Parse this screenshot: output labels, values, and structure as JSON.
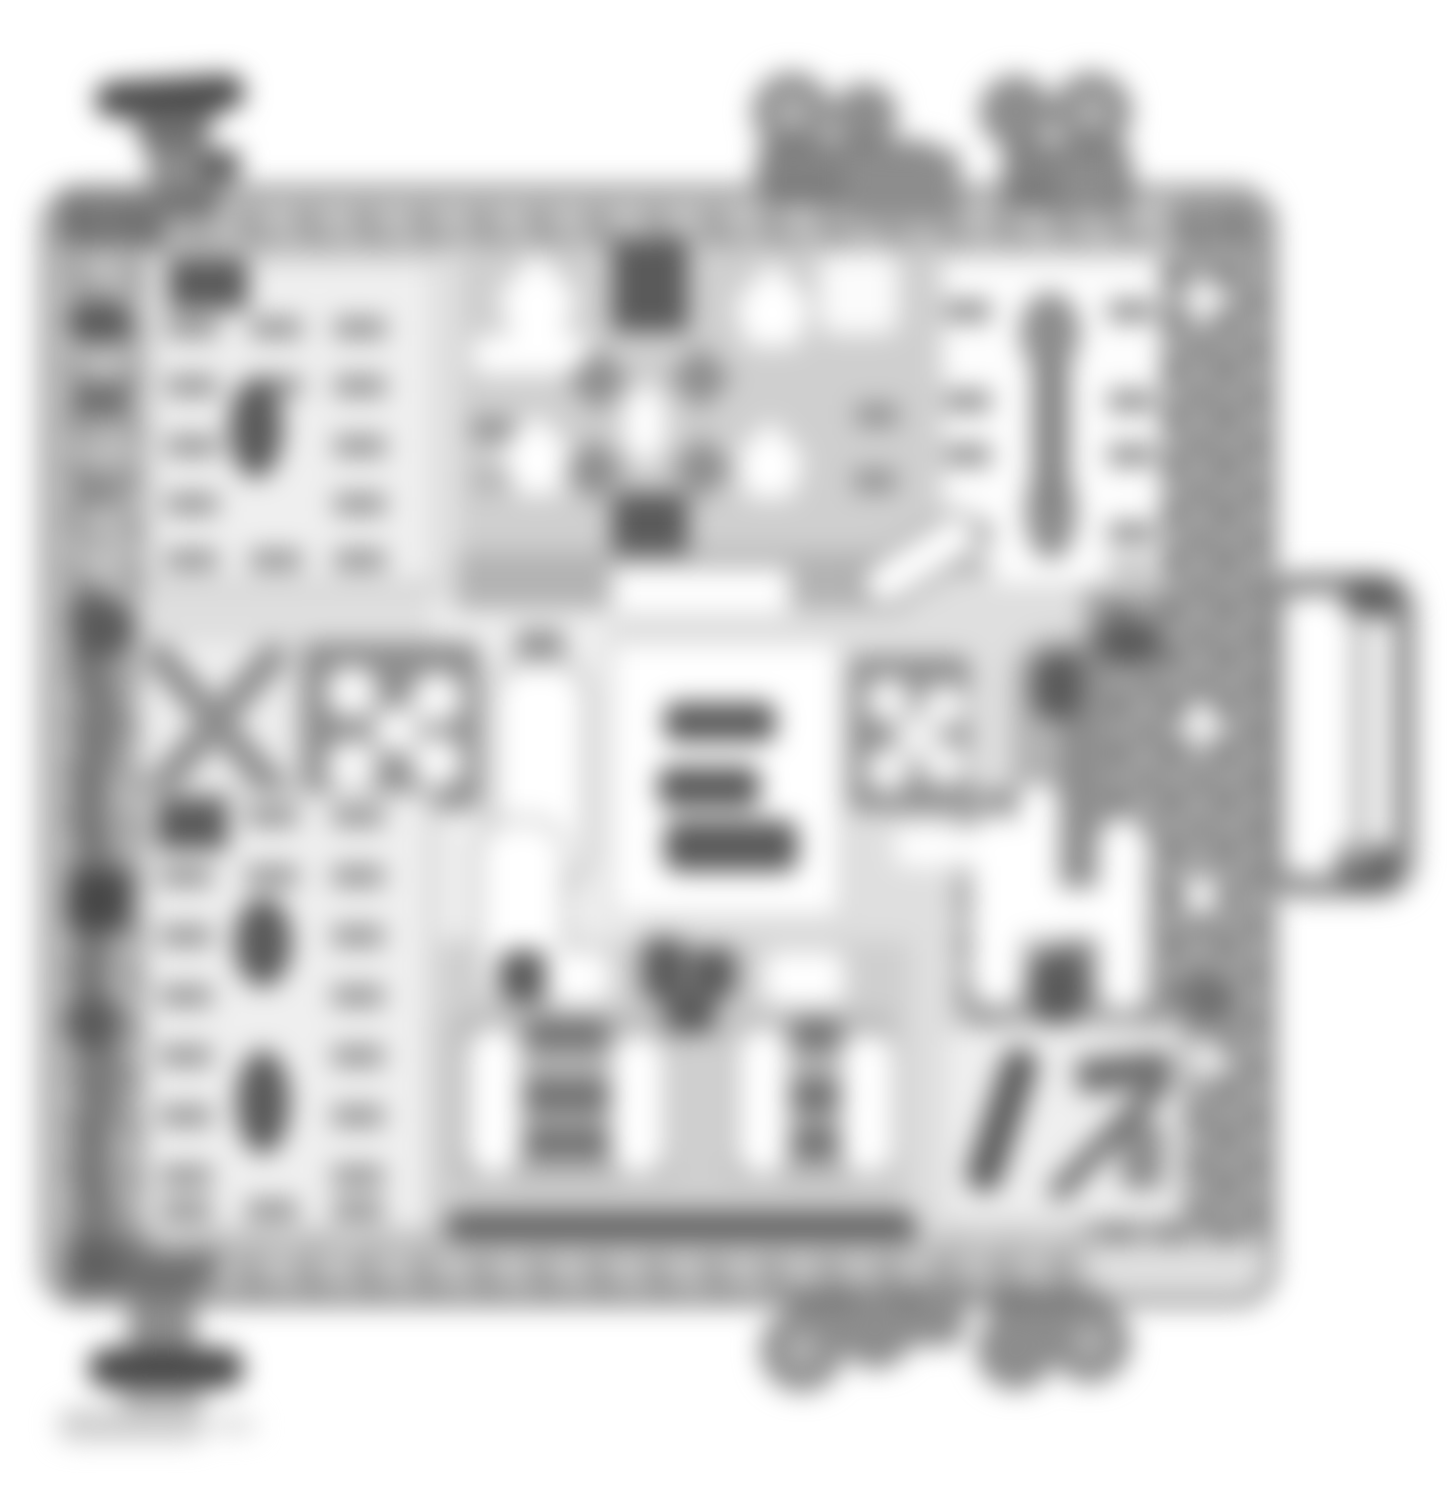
{
  "page": {
    "background": "#ffffff"
  },
  "colors": {
    "paper": "#ffffff",
    "ink_dark": "#474747",
    "ink_dark2": "#5a5a5a",
    "ink": "#6f6f6f",
    "ink_mid": "#8d8d8d",
    "ink_light": "#b3b3b3",
    "ink_faint": "#cfcfcf",
    "field": "#dfdfdf",
    "panel": "#efefef",
    "white": "#ffffff"
  },
  "diagram": {
    "note": "entire figure is blurred; no text is legible in the pixels",
    "legible_text": [],
    "components": [
      "stud-top-left",
      "connector-top-a",
      "connector-top-b",
      "body-outline",
      "top-rim-mottle",
      "left-terminal-strip",
      "right-fuse-bank",
      "bottom-rim-mottle",
      "relay-block-upper-left",
      "cluster-top-center",
      "relay-block-upper-right",
      "diagonal-slash",
      "x-pattern-relay",
      "dice-pattern-relay",
      "center-capsule",
      "center-label-block",
      "dot-pattern-relay",
      "right-capsule-column",
      "relay-block-lower-left",
      "bottom-capsule",
      "dark-cluster",
      "relay-bottom-left",
      "relay-bottom-center",
      "h-pattern-block",
      "relay-bottom-right",
      "bottom-bar",
      "side-tab",
      "stud-bottom-left",
      "connector-bottom-a",
      "connector-bottom-b",
      "figure-code-smudge"
    ]
  }
}
